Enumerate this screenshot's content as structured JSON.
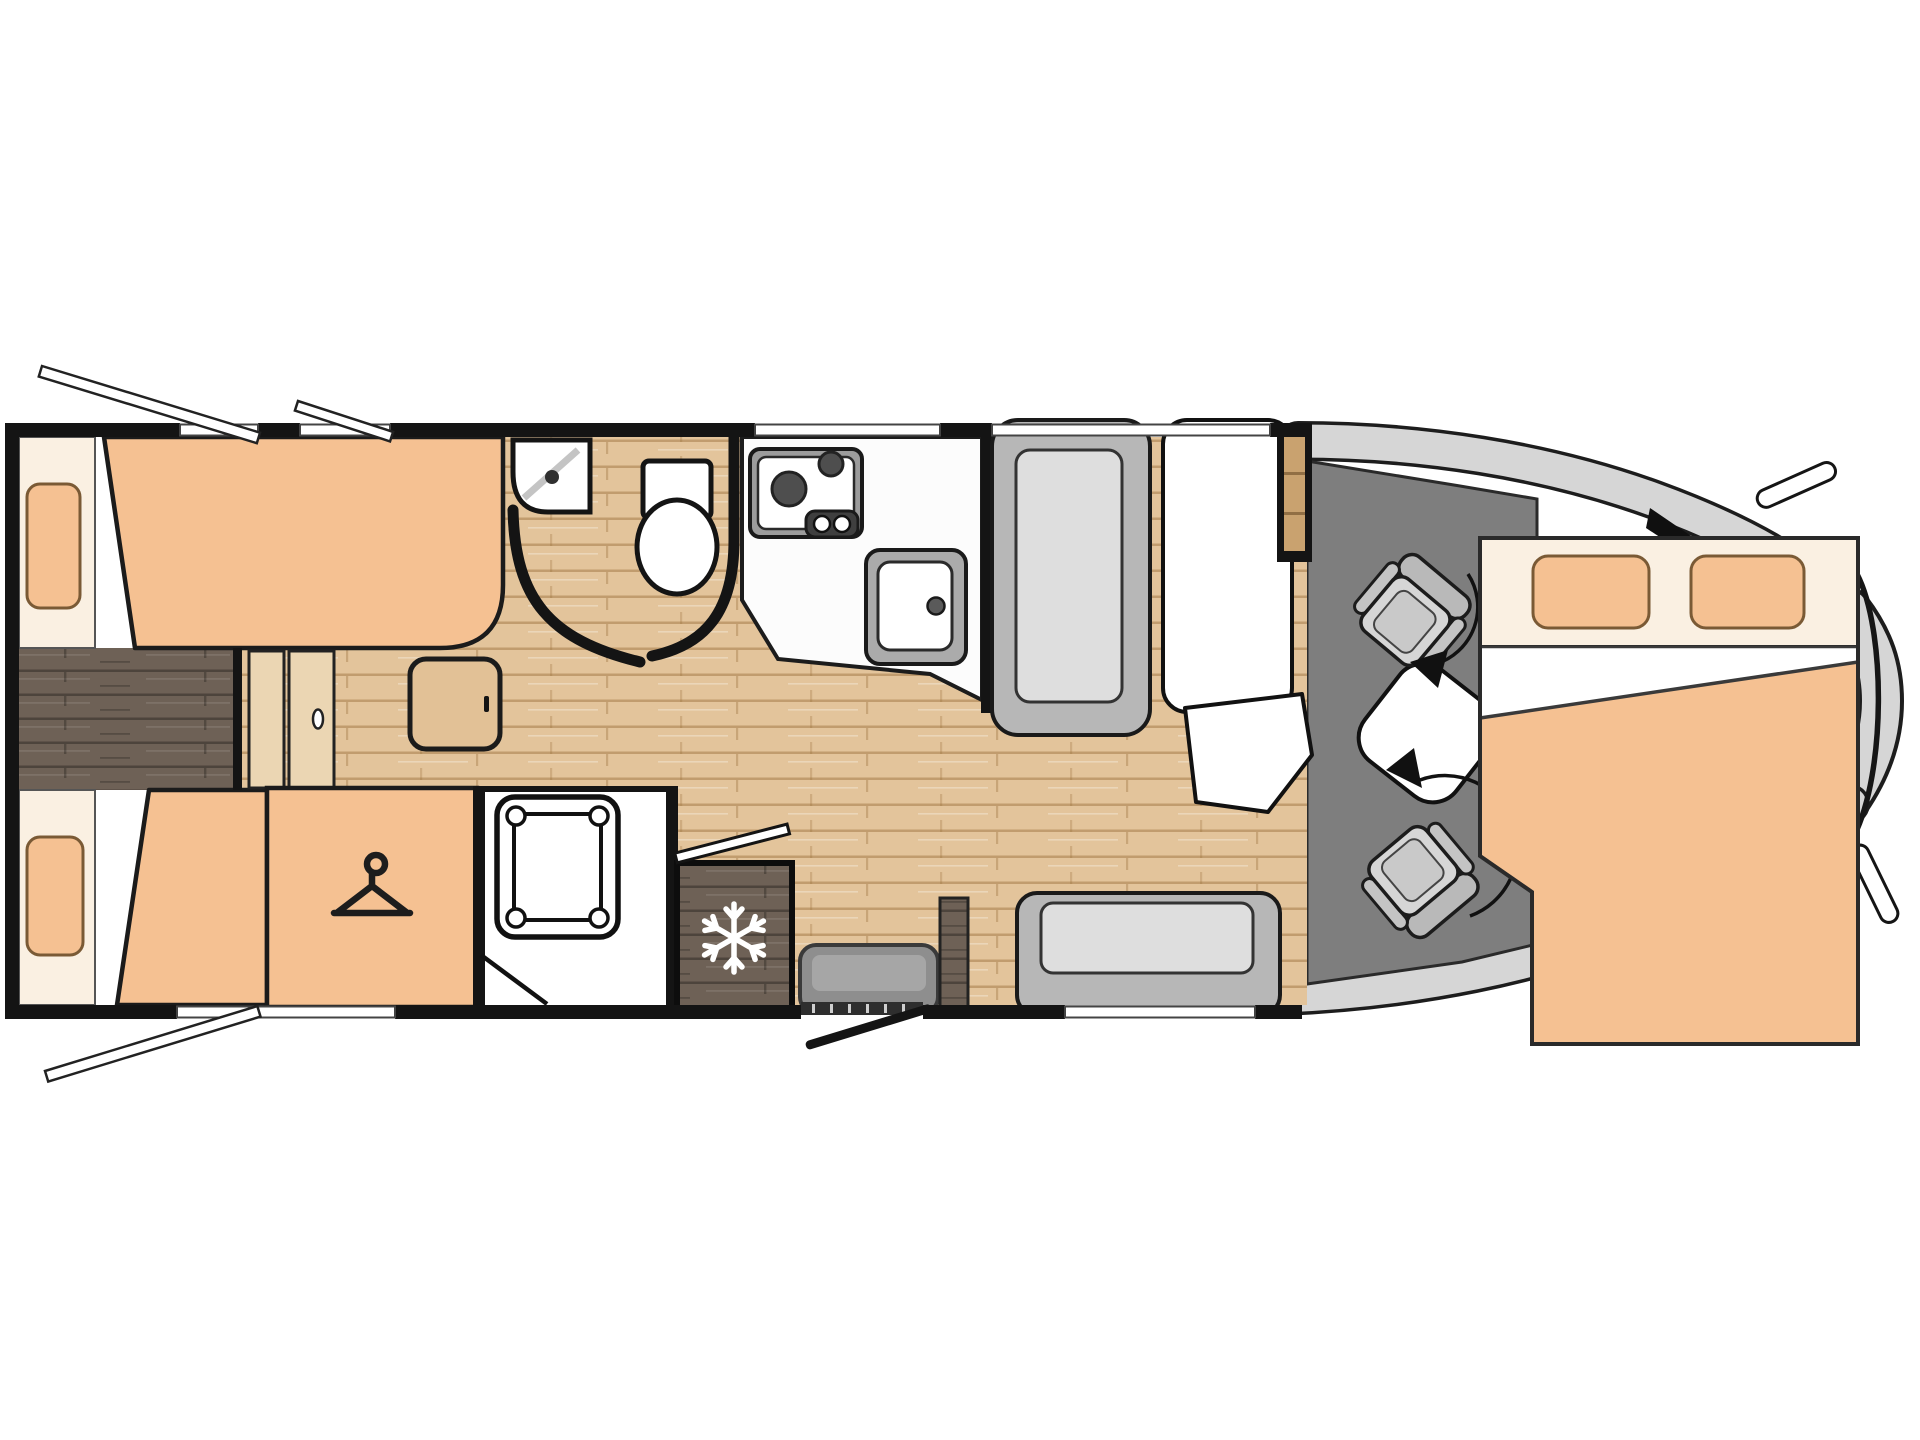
{
  "diagram": {
    "type": "motorhome-floorplan",
    "view": "top-down 2D floor plan, no text labels",
    "orientation": "vehicle cab at right, rear bedroom at left, entry door on bottom wall"
  },
  "colors": {
    "peach": "#F5C192",
    "cream": "#FAF0E2",
    "pillow_outline": "#7A5A35",
    "wood_light": "#E3C49B",
    "wood_grain": "#B08352",
    "wood_dark": "#6E6156",
    "wood_dark_grain": "#4E4338",
    "door_wood": "#EBD6B3",
    "cabinet_wood": "#C9A26F",
    "wall": "#141414",
    "cab_floor": "#7E7E7E",
    "body_gray": "#D6D6D6",
    "seat_frame": "#B9B9B9",
    "seat_cushion": "#D6D6D6",
    "bench_frame": "#B7B7B7",
    "bench_cushion": "#DEDEDE",
    "fixture_white": "#FFFFFF",
    "steel": "#ABABAB",
    "burner_dark": "#4E4E4E",
    "step_gray": "#8E8E8E"
  },
  "rooms": [
    {
      "name": "rear-bedroom",
      "items": [
        "twin-single-bed-upper",
        "twin-single-bed-lower",
        "pillow x2",
        "center-walkway",
        "wardrobe",
        "bedroom-door",
        "side-table"
      ]
    },
    {
      "name": "washroom",
      "items": [
        "corner-washbasin",
        "toilet",
        "curved-partition-walls"
      ]
    },
    {
      "name": "shower-room",
      "items": [
        "shower-tray",
        "shower-door"
      ]
    },
    {
      "name": "kitchen",
      "items": [
        "worktop",
        "two-burner-hob",
        "control-knobs",
        "sink-with-tap",
        "refrigerator"
      ]
    },
    {
      "name": "lounge",
      "items": [
        "forward-bench-seat",
        "dinette-table",
        "table-extension-leaf",
        "side-bench-seat",
        "entry-step",
        "entry-door",
        "tall-cabinet",
        "side-cabinet"
      ]
    },
    {
      "name": "cab",
      "items": [
        "driver-swivel-seat",
        "passenger-swivel-seat",
        "windshield",
        "wing-mirror x2",
        "overcab-double-bed"
      ]
    }
  ],
  "icons": [
    {
      "name": "hanger-icon",
      "meaning": "wardrobe / clothes storage"
    },
    {
      "name": "snowflake-icon",
      "meaning": "refrigerator"
    },
    {
      "name": "rotation-arrow-icon",
      "meaning": "swivelling cab seat",
      "count": 2
    },
    {
      "name": "open-window-marker",
      "meaning": "opening window flap",
      "count": 3
    }
  ],
  "window_openings": {
    "top_wall": 4,
    "bottom_wall": 2
  }
}
